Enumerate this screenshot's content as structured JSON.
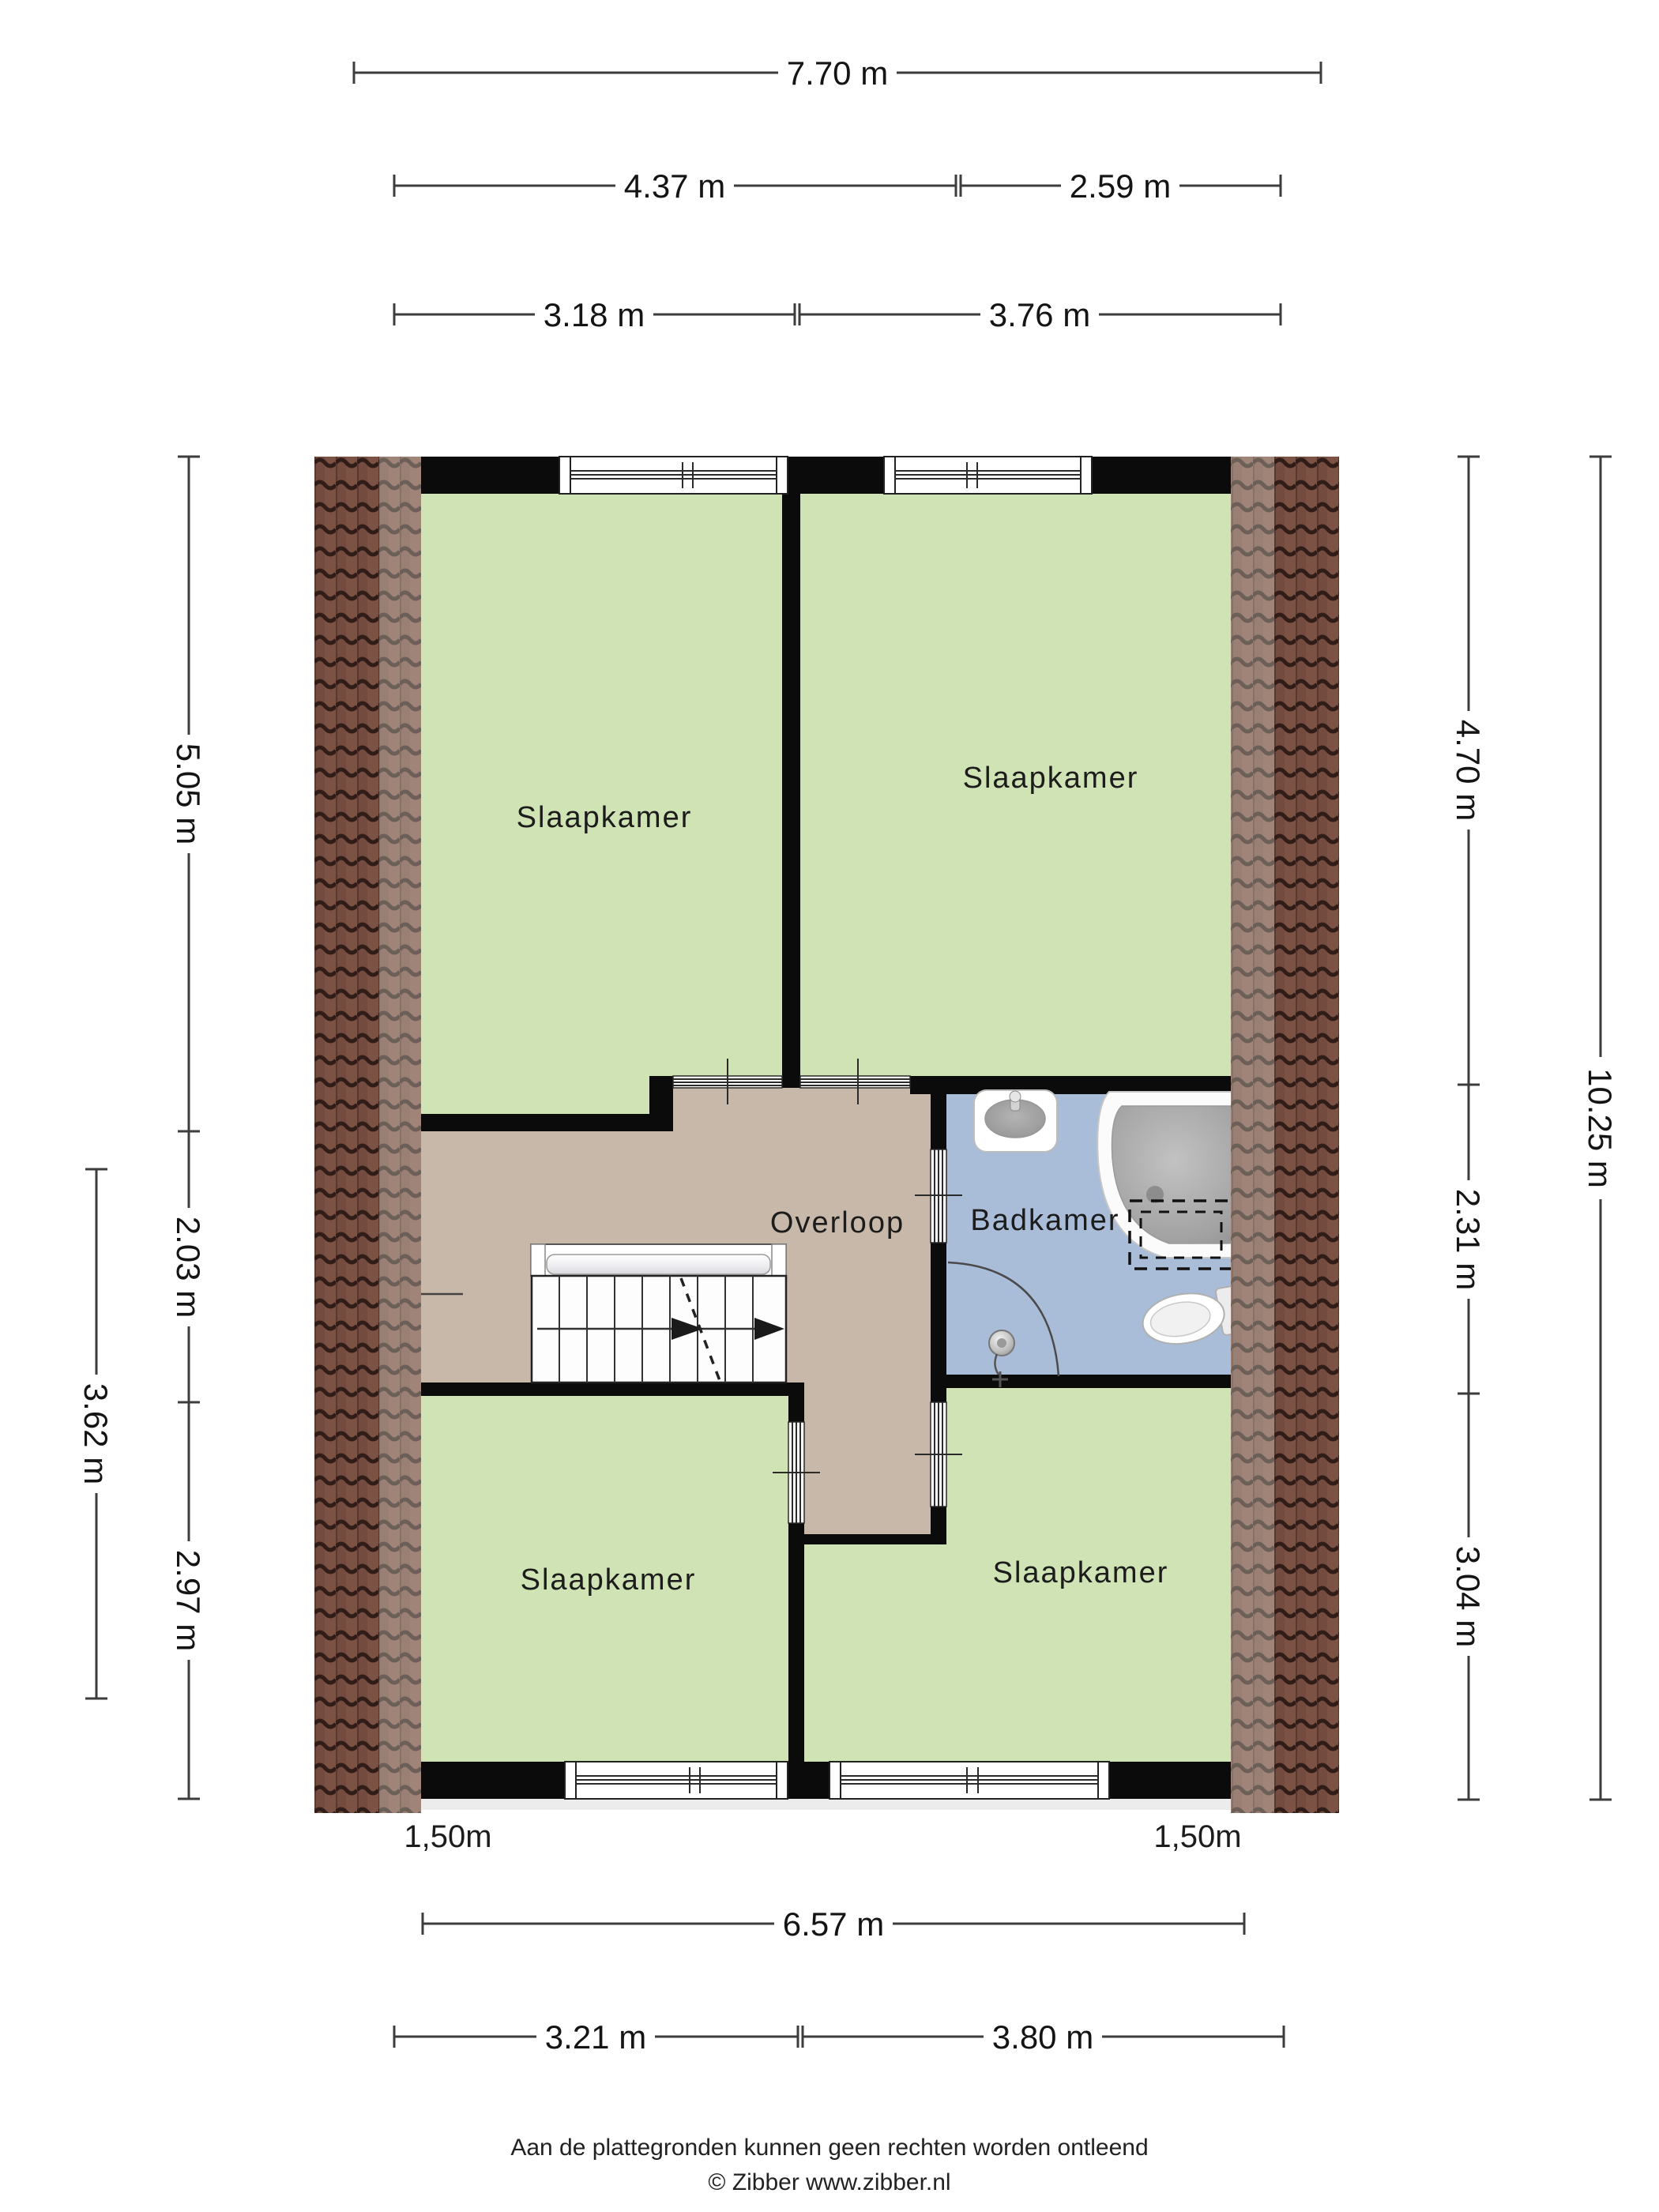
{
  "title": "Floor plan first floor (verdieping)",
  "rooms": {
    "top_left": "Slaapkamer",
    "top_right": "Slaapkamer",
    "bottom_left": "Slaapkamer",
    "bottom_right": "Slaapkamer",
    "landing": "Overloop",
    "bathroom": "Badkamer"
  },
  "dimensions": {
    "top_total": "7.70 m",
    "top_row2_left": "4.37 m",
    "top_row2_right": "2.59 m",
    "top_row3_left": "3.18 m",
    "top_row3_right": "3.76 m",
    "left_seg1": "5.05 m",
    "left_seg2": "2.03 m",
    "left_seg3": "2.97 m",
    "left_outer": "3.62 m",
    "right_seg1": "4.70 m",
    "right_seg2": "2.31 m",
    "right_seg3": "3.04 m",
    "right_total": "10.25 m",
    "bottom_total": "6.57 m",
    "bottom_row2_left": "3.21 m",
    "bottom_row2_right": "3.80 m",
    "headroom_left": "1,50m",
    "headroom_right": "1,50m"
  },
  "footer": {
    "line1": "Aan de plattegronden kunnen geen rechten worden ontleend",
    "line2": "© Zibber www.zibber.nl"
  },
  "colors": {
    "bedroom_green": "#cfe3b4",
    "landing_tan": "#c8b8a9",
    "bathroom_blue": "#a9bdd9",
    "wall_black": "#0b0b0b",
    "roof_base": "#7c5244",
    "roof_line": "#311d18"
  }
}
